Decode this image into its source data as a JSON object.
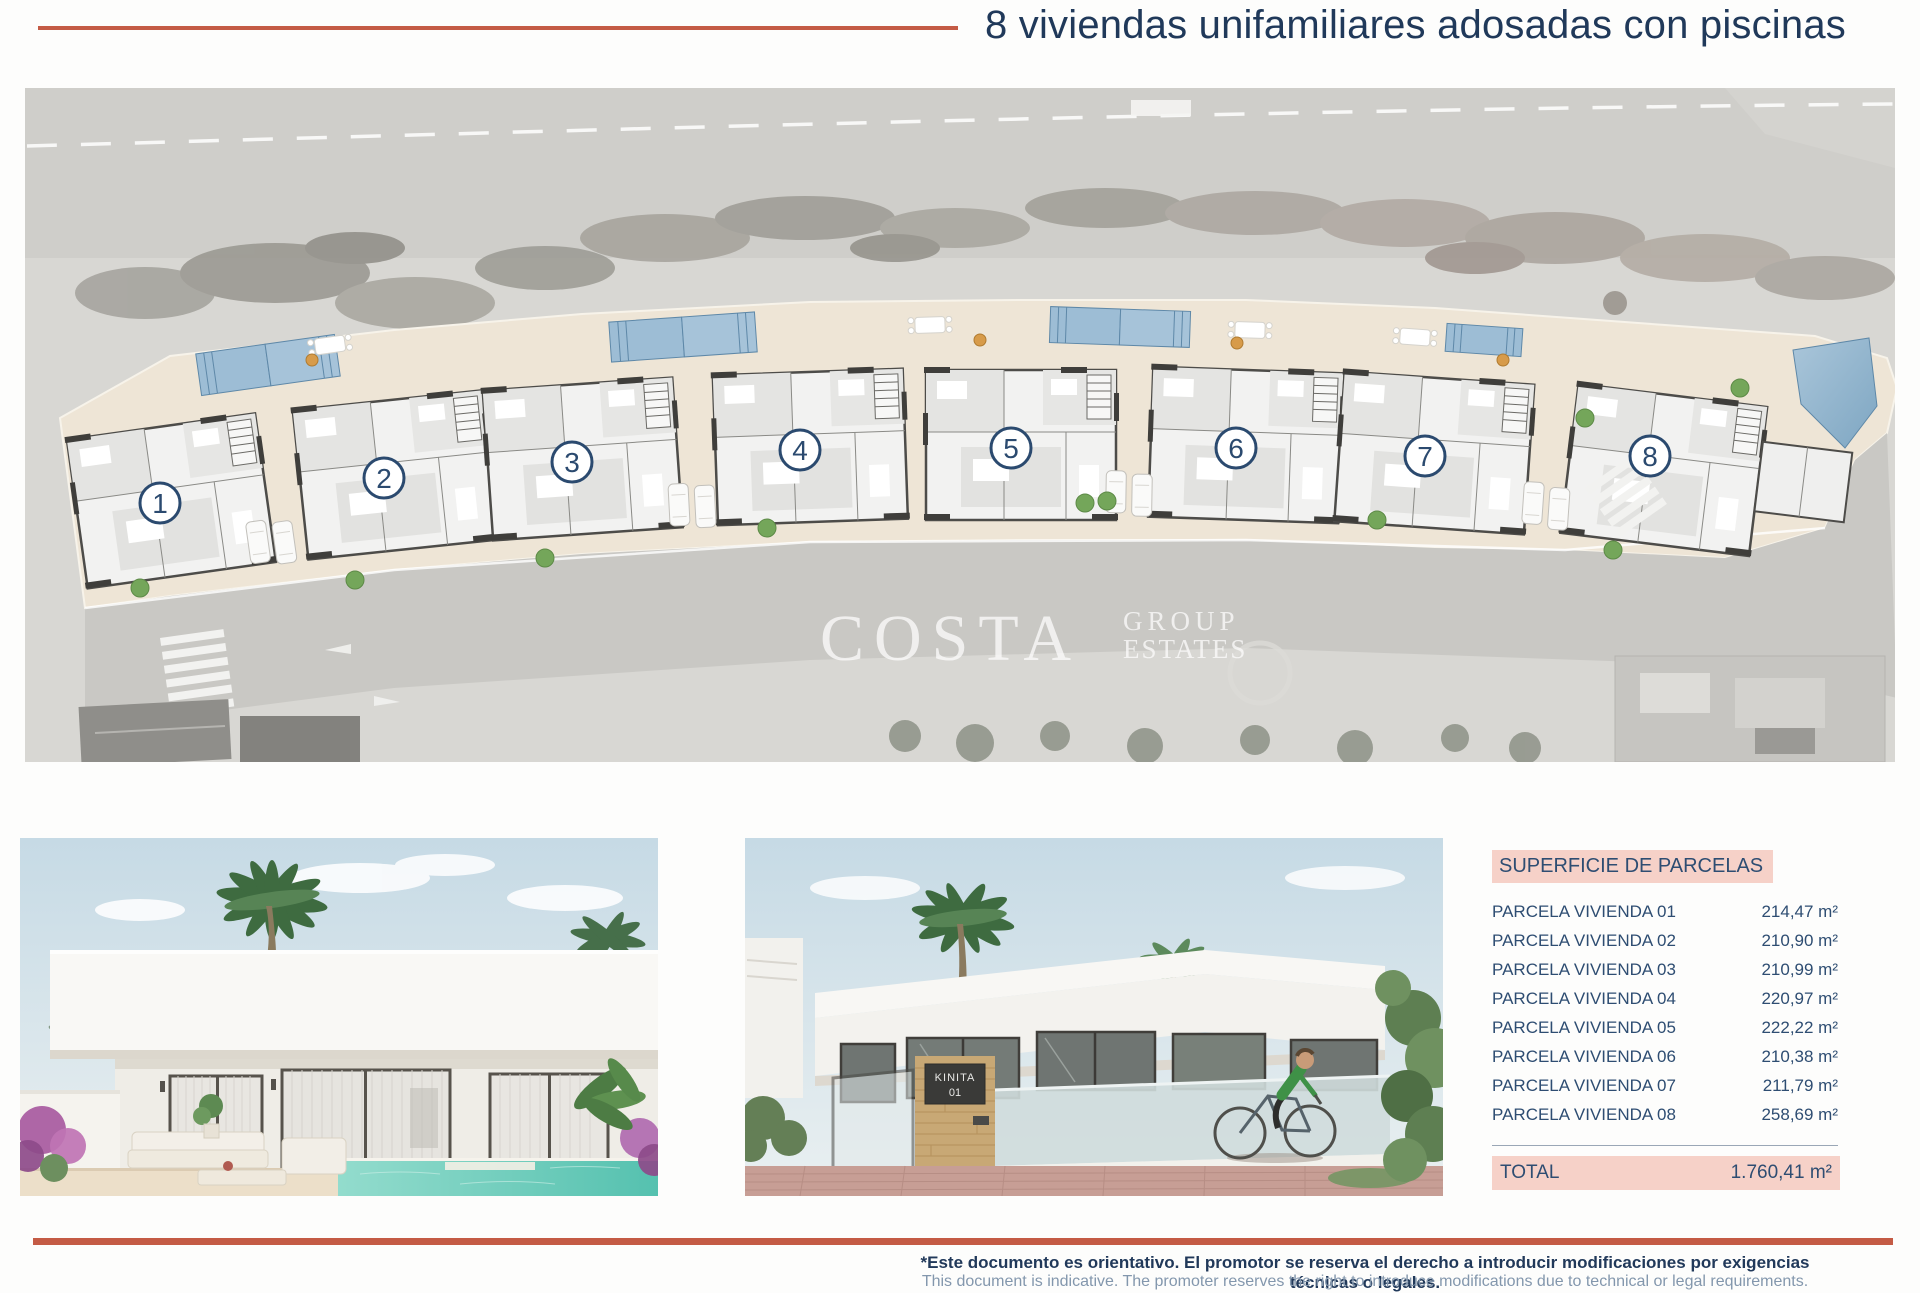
{
  "header": {
    "title": "8 viviendas unifamiliares adosadas con piscinas"
  },
  "colors": {
    "accent": "#c45b45",
    "navy": "#20395a",
    "table_salmon": "#f6d1c8",
    "plan_pool_blue": "#9dbdd5",
    "render_pool_teal": "#63c7b6"
  },
  "site_plan": {
    "watermark": {
      "main": "COSTA",
      "sub_top": "GROUP",
      "sub_bottom": "ESTATES"
    },
    "units": [
      {
        "number": "1"
      },
      {
        "number": "2"
      },
      {
        "number": "3"
      },
      {
        "number": "4"
      },
      {
        "number": "5"
      },
      {
        "number": "6"
      },
      {
        "number": "7"
      },
      {
        "number": "8"
      }
    ]
  },
  "street_render": {
    "sign_line1": "KINITA",
    "sign_line2": "01"
  },
  "table": {
    "header": "SUPERFICIE DE PARCELAS",
    "rows": [
      {
        "label": "PARCELA VIVIENDA 01",
        "value": "214,47 m²"
      },
      {
        "label": "PARCELA VIVIENDA 02",
        "value": "210,90 m²"
      },
      {
        "label": "PARCELA VIVIENDA 03",
        "value": "210,99 m²"
      },
      {
        "label": "PARCELA VIVIENDA 04",
        "value": "220,97 m²"
      },
      {
        "label": "PARCELA VIVIENDA 05",
        "value": "222,22 m²"
      },
      {
        "label": "PARCELA VIVIENDA 06",
        "value": "210,38 m²"
      },
      {
        "label": "PARCELA VIVIENDA 07",
        "value": "211,79 m²"
      },
      {
        "label": "PARCELA VIVIENDA 08",
        "value": "258,69 m²"
      }
    ],
    "total_label": "TOTAL",
    "total_value": "1.760,41 m²"
  },
  "footer": {
    "line1": "*Este documento es orientativo. El promotor se reserva el derecho a introducir modificaciones por exigencias técnicas o legales.",
    "line2": "This document is indicative. The promoter reserves the right to introduce modifications due to technical or legal requirements."
  }
}
